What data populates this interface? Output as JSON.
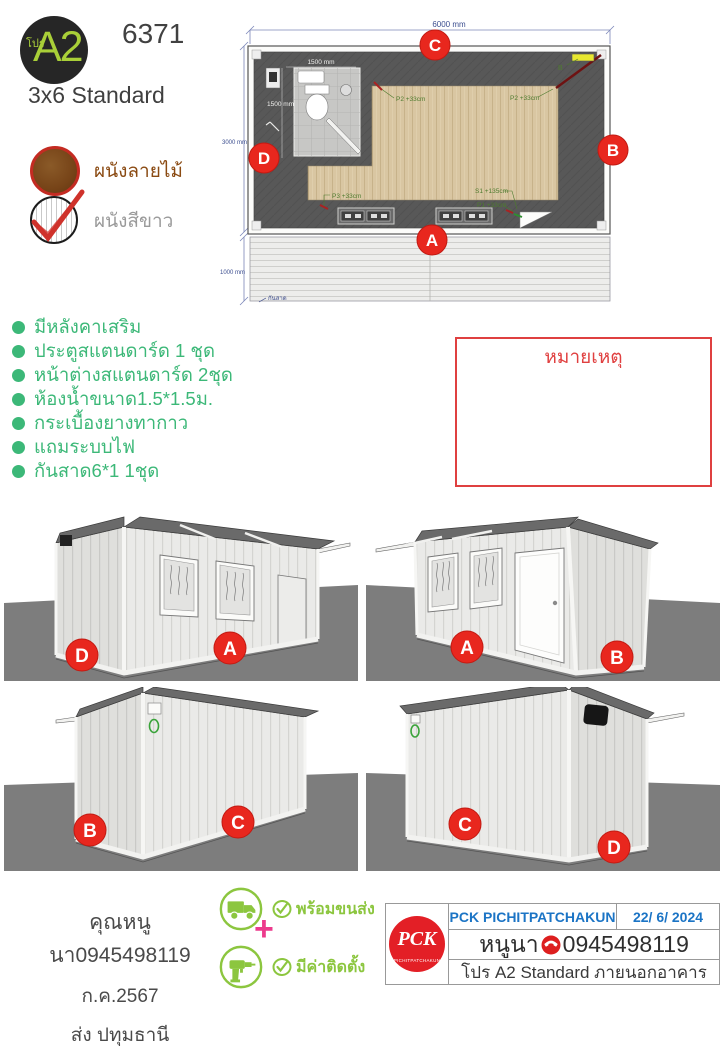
{
  "header": {
    "badge_prefix": "โปร",
    "badge_code": "A2",
    "doc_number": "6371",
    "model_name": "3x6 Standard"
  },
  "legend": {
    "wood_label": "ผนังลายไม้",
    "white_label": "ผนังสีขาว"
  },
  "floor_plan": {
    "dim_width": "6000 mm",
    "dim_depth": "3000 mm",
    "dim_awning": "1000 mm",
    "dim_bath_width": "1500 mm",
    "dim_bath_depth": "1500 mm",
    "awning_label": "กันสาด",
    "panel_label": "B",
    "points": {
      "p2_left": "P2 +33cm",
      "p2_right": "P2 +33cm",
      "p3": "P3 +33cm",
      "s1": "S1 +135cm",
      "p1": "P1 +33cm"
    },
    "markers": {
      "a": "A",
      "b": "B",
      "c": "C",
      "d": "D"
    }
  },
  "features": [
    "มีหลังคาเสริม",
    "ประตูสแตนดาร์ด 1 ชุด",
    "หน้าต่างสแตนดาร์ด 2ชุด",
    "ห้องน้ำขนาด1.5*1.5ม.",
    "กระเบื้องยางทากาว",
    "แถมระบบไฟ",
    "กันสาด6*1 1ชุด"
  ],
  "note": {
    "title": "หมายเหตุ"
  },
  "views": {
    "top_left": {
      "left": "D",
      "right": "A"
    },
    "top_right": {
      "left": "A",
      "right": "B"
    },
    "bottom_left": {
      "left": "B",
      "right": "C"
    },
    "bottom_right": {
      "left": "C",
      "right": "D"
    }
  },
  "footer": {
    "customer": "คุณหนูนา0945498119",
    "month": "ก.ค.2567",
    "shipping": "ส่ง ปทุมธานี",
    "service_delivery": "พร้อมขนส่ง",
    "service_install": "มีค่าติดตั้ง",
    "plus_sign": "+",
    "table": {
      "company": "PCK PICHITPATCHAKUN",
      "date": "22/ 6/ 2024",
      "contact_name": "หนูนา",
      "contact_phone": "0945498119",
      "product_line": "โปร A2 Standard ภายนอกอาคาร",
      "logo_monogram": "PCK",
      "logo_subtext": "PICHITPATCHAKUN"
    }
  },
  "colors": {
    "accent_green": "#3cb878",
    "label_green": "#4e7b2f",
    "badge_red": "#e8271e",
    "note_red": "#e04040",
    "table_blue": "#1b74c5",
    "icon_green": "#8cc63f",
    "plus_pink": "#ec3a8c",
    "logo_lime": "#a9cf38",
    "dim_navy": "#3c4e8f"
  }
}
